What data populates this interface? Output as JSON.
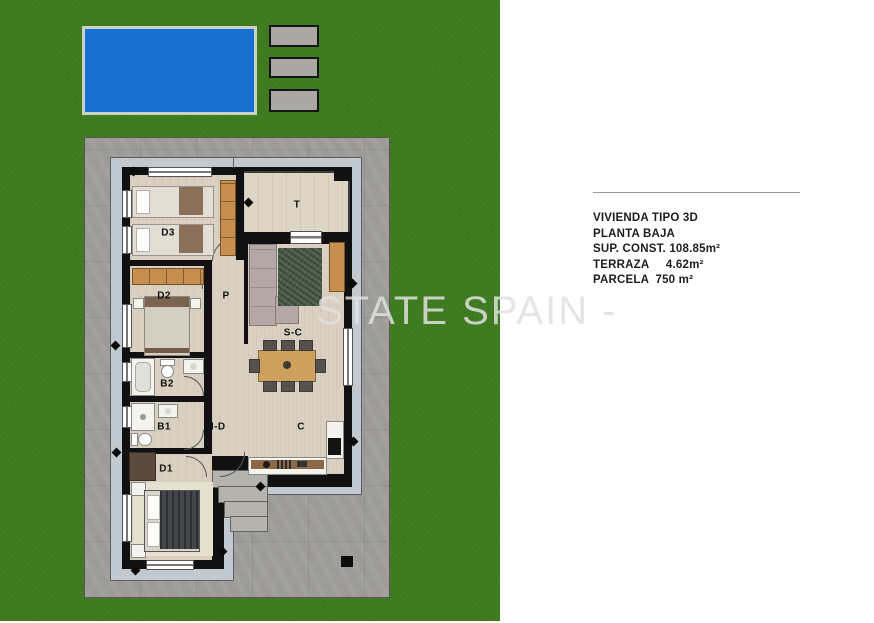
{
  "watermark": {
    "text": "STATE SPAIN -"
  },
  "info_panel": {
    "lines": [
      "VIVIENDA TIPO 3D",
      "PLANTA BAJA",
      "SUP. CONST. 108.85m²",
      "TERRAZA     4.62m²",
      "PARCELA  750 m²"
    ]
  },
  "plan": {
    "room_labels": [
      {
        "id": "terrace",
        "label": "T"
      },
      {
        "id": "bedroom-3",
        "label": "D3"
      },
      {
        "id": "bedroom-2",
        "label": "D2"
      },
      {
        "id": "passage",
        "label": "P"
      },
      {
        "id": "living-dining",
        "label": "S-C"
      },
      {
        "id": "bathroom-2",
        "label": "B2"
      },
      {
        "id": "bathroom-1",
        "label": "B1"
      },
      {
        "id": "hall",
        "label": "H-D"
      },
      {
        "id": "kitchen",
        "label": "C"
      },
      {
        "id": "bedroom-1",
        "label": "D1"
      }
    ]
  },
  "colors": {
    "grass": "#3e7b1e",
    "pool": "#1a6fd3",
    "poolborder": "#c9d2c4",
    "pad": "#a9a8a5",
    "drive": "#9c9b97",
    "walk": "#c1cad0",
    "wall": "#111111",
    "floor": "#d9d0c1",
    "tile": "#ddd5c6",
    "wood": "#c68f4f",
    "wooddark": "#8d6848",
    "rug": "#4f5e4b",
    "sofa": "#b3a8a6",
    "duvet": "#45464b",
    "fixture": "#f4f3ee"
  }
}
